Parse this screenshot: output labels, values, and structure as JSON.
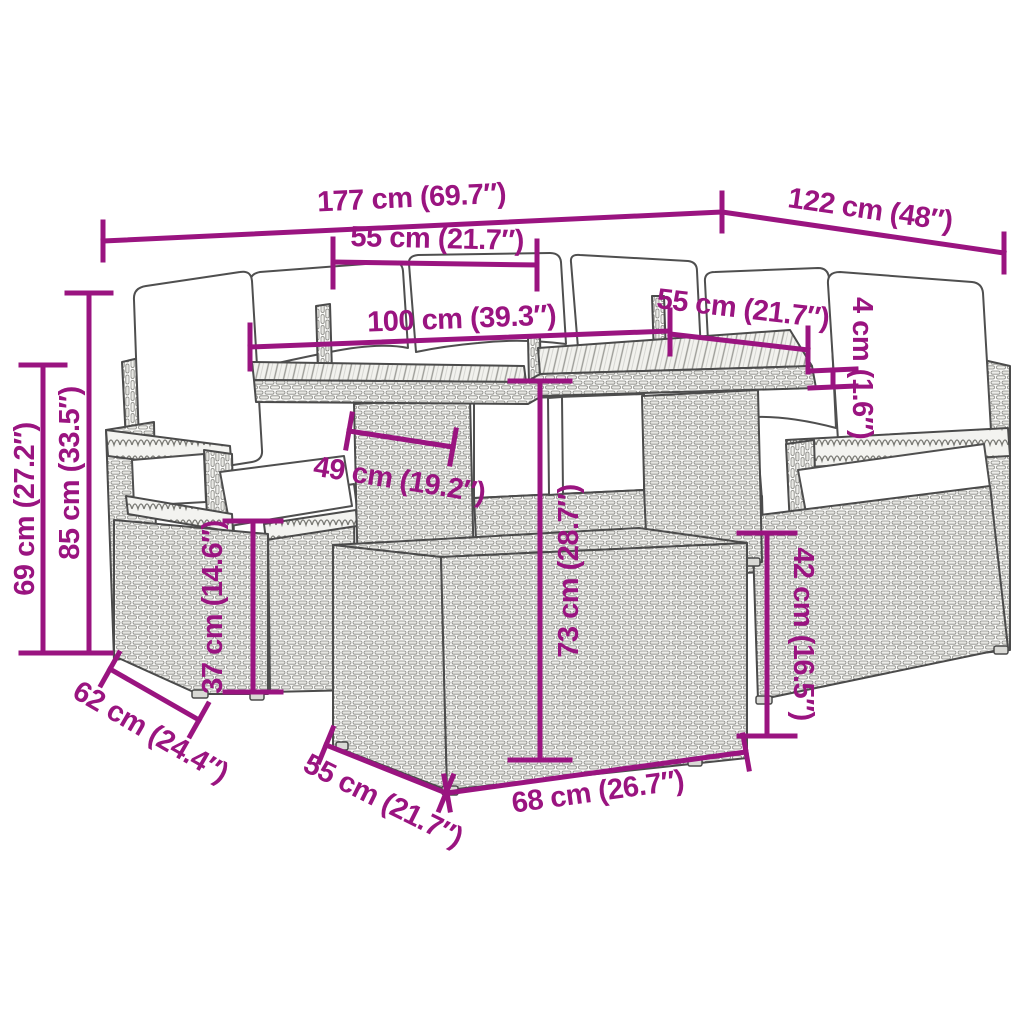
{
  "diagram": {
    "type": "product-dimension-diagram",
    "subject": "rattan-garden-furniture-set",
    "colors": {
      "dimension_accent": "#9a1480",
      "outline": "#4b4b4b",
      "cushion": "#ffffff",
      "rattan": "#ededea",
      "background": "#ffffff"
    },
    "dims": {
      "d177": "177 cm (69.7″)",
      "d122": "122 cm (48″)",
      "d55top": "55 cm (21.7″)",
      "d100": "100 cm (39.3″)",
      "d55right": "55 cm (21.7″)",
      "d4": "4 cm (1.6″)",
      "d69": "69 cm (27.2″)",
      "d85": "85 cm (33.5″)",
      "d49": "49 cm (19.2″)",
      "d37": "37 cm (14.6″)",
      "d73": "73 cm (28.7″)",
      "d42": "42 cm (16.5″)",
      "d62": "62 cm (24.4″)",
      "d55bot": "55 cm (21.7″)",
      "d68": "68 cm (26.7″)"
    }
  }
}
